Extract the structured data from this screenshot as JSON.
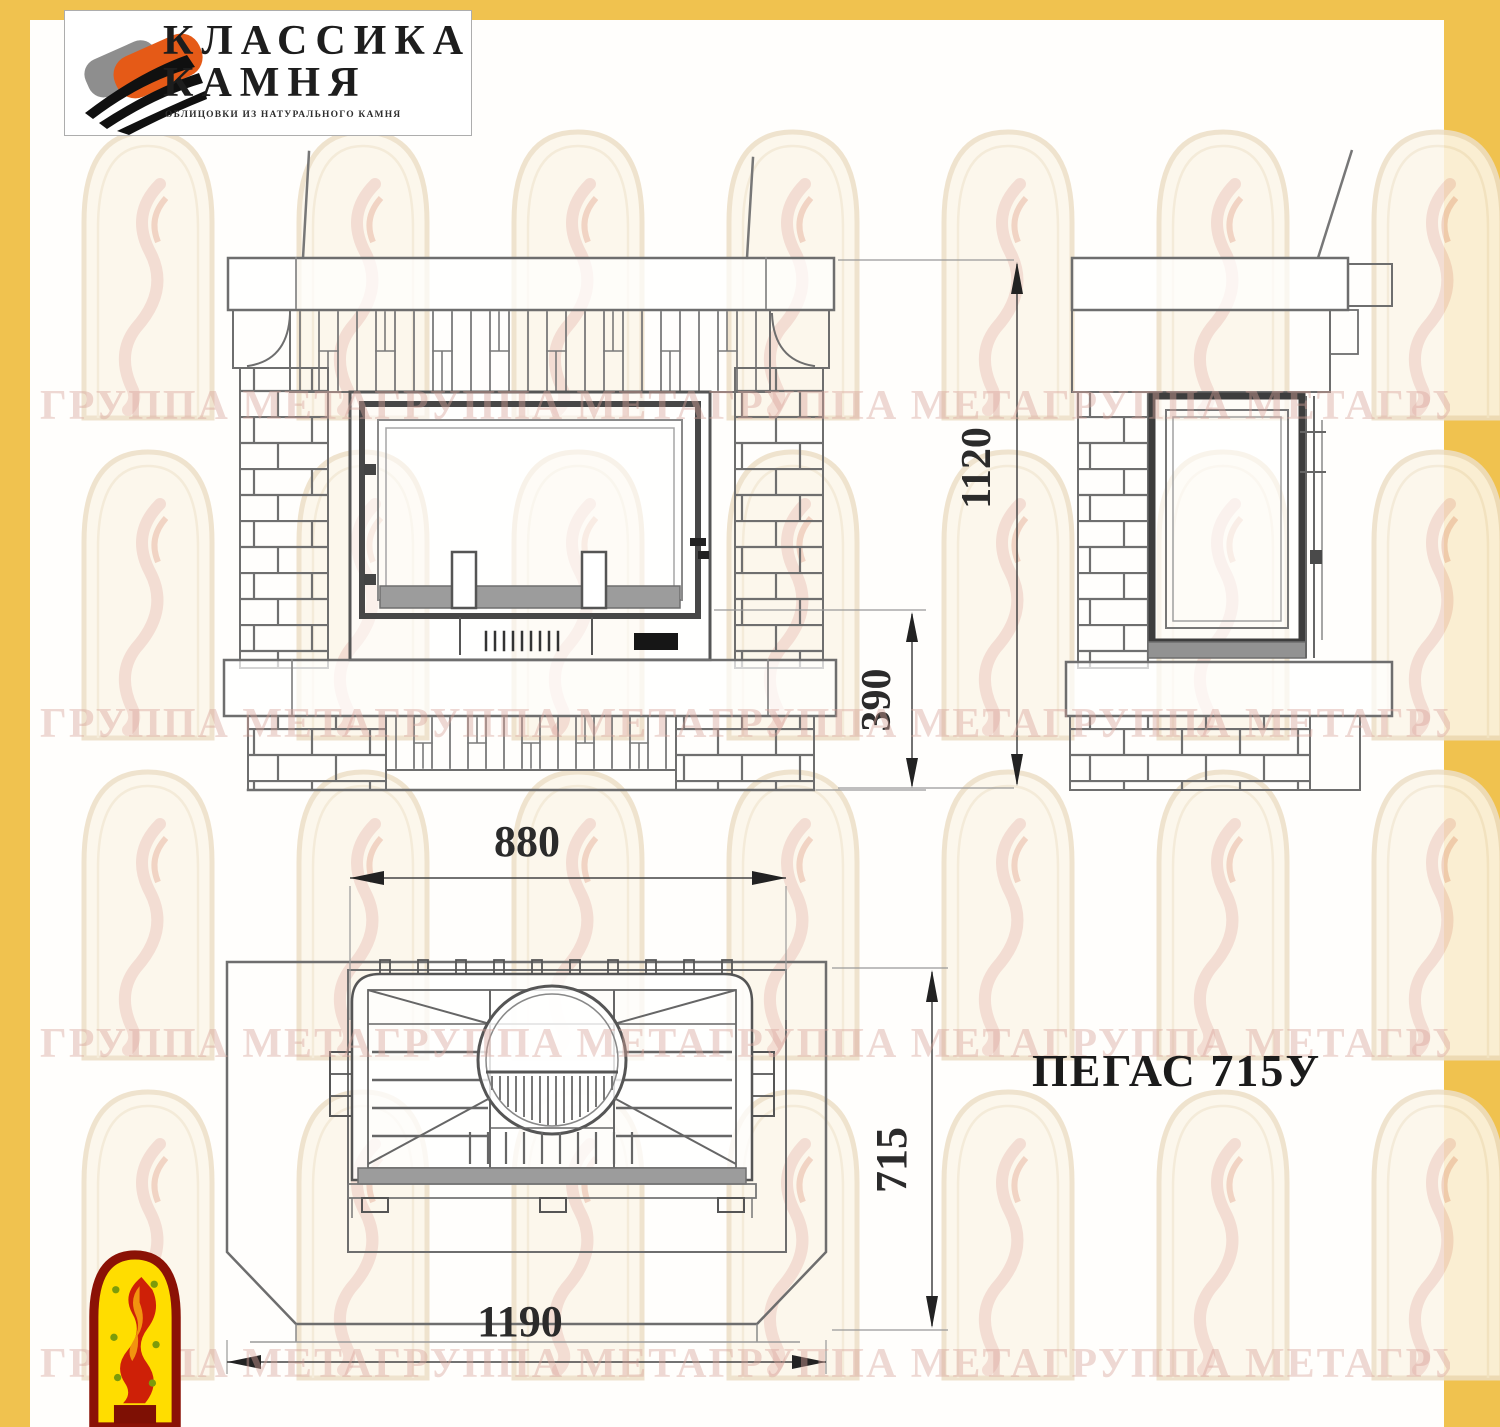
{
  "company_logo": {
    "title_line1": "КЛАССИКА",
    "title_line2": "КАМНЯ",
    "subtitle": "ОБЛИЦОВКИ ИЗ НАТУРАЛЬНОГО КАМНЯ"
  },
  "model_label": "ПЕГАС 715У",
  "dimensions": {
    "overall_height": "1120",
    "plinth_height": "390",
    "firebox_width": "880",
    "overall_width": "1190",
    "depth": "715"
  },
  "watermark_text": "ГРУППА МЕТАГРУППА МЕТАГРУППА МЕТАГРУППА МЕТАГРУППА МЕТА",
  "colors": {
    "frame_yellow": "#F0C24F",
    "line_gray": "#6E6E6E",
    "watermark_pink": "#D9A49B",
    "logo_orange": "#E55A17"
  }
}
